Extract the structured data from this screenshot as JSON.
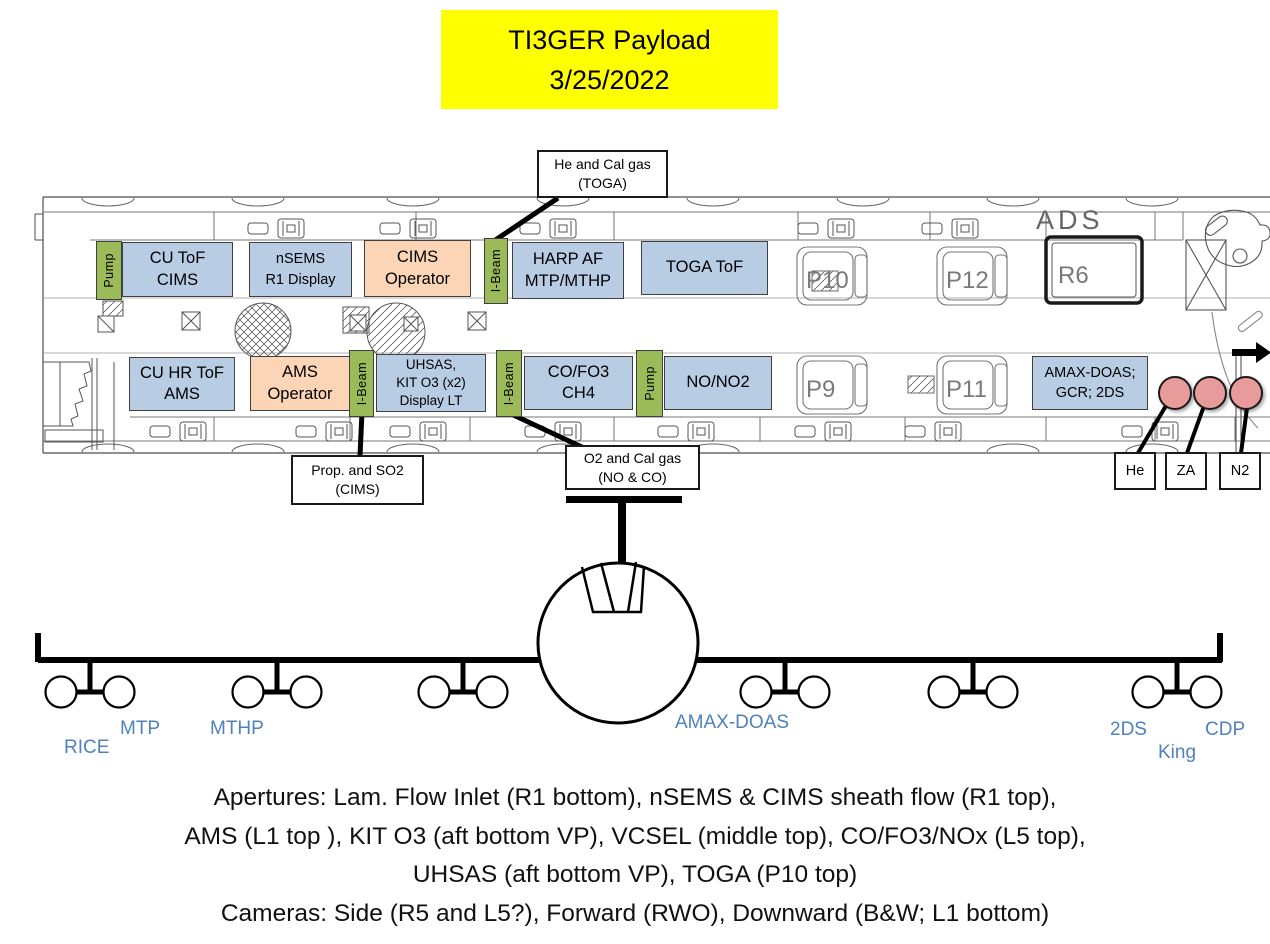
{
  "title": {
    "line1": "TI3GER Payload",
    "line2": "3/25/2022"
  },
  "plan": {
    "ads_label": "ADS",
    "seats": {
      "p10": "P10",
      "p12": "P12",
      "r6": "R6",
      "p9": "P9",
      "p11": "P11"
    },
    "top_row": [
      {
        "label": "Pump"
      },
      {
        "label": "CU ToF\nCIMS"
      },
      {
        "label": "nSEMS\nR1 Display"
      },
      {
        "label": "CIMS\nOperator"
      },
      {
        "label": "I-Beam"
      },
      {
        "label": "HARP AF\nMTP/MTHP"
      },
      {
        "label": "TOGA ToF"
      }
    ],
    "bottom_row": [
      {
        "label": "CU HR ToF\nAMS"
      },
      {
        "label": "AMS\nOperator"
      },
      {
        "label": "I-Beam"
      },
      {
        "label": "UHSAS,\nKIT O3 (x2)\nDisplay LT"
      },
      {
        "label": "I-Beam"
      },
      {
        "label": "CO/FO3\nCH4"
      },
      {
        "label": "Pump"
      },
      {
        "label": "NO/NO2"
      },
      {
        "label": "AMAX-DOAS;\nGCR; 2DS"
      }
    ],
    "callouts": {
      "toga_gas": "He and Cal gas\n(TOGA)",
      "cims_gas": "Prop. and SO2\n(CIMS)",
      "noco_gas": "O2 and Cal gas\n(NO & CO)"
    },
    "bottles": [
      {
        "label": "He"
      },
      {
        "label": "ZA"
      },
      {
        "label": "N2"
      }
    ]
  },
  "front": {
    "labels": {
      "rice": "RICE",
      "mtp": "MTP",
      "mthp": "MTHP",
      "amax": "AMAX-DOAS",
      "twods": "2DS",
      "king": "King",
      "cdp": "CDP"
    }
  },
  "footer": {
    "line1": "Apertures: Lam. Flow Inlet (R1 bottom), nSEMS & CIMS sheath flow (R1 top),",
    "line2": "AMS (L1 top ), KIT O3 (aft bottom VP), VCSEL (middle top), CO/FO3/NOx (L5 top),",
    "line3": "UHSAS (aft bottom VP), TOGA (P10 top)",
    "line4": "Cameras: Side (R5 and L5?), Forward (RWO), Downward (B&W; L1 bottom)"
  },
  "colors": {
    "instrument_blue": "#b8cce4",
    "operator_orange": "#fbd5b5",
    "structure_green": "#9bbb59",
    "bottle_pink": "#e89b9b",
    "title_yellow": "#ffff00",
    "wing_label_blue": "#4f81bd"
  }
}
